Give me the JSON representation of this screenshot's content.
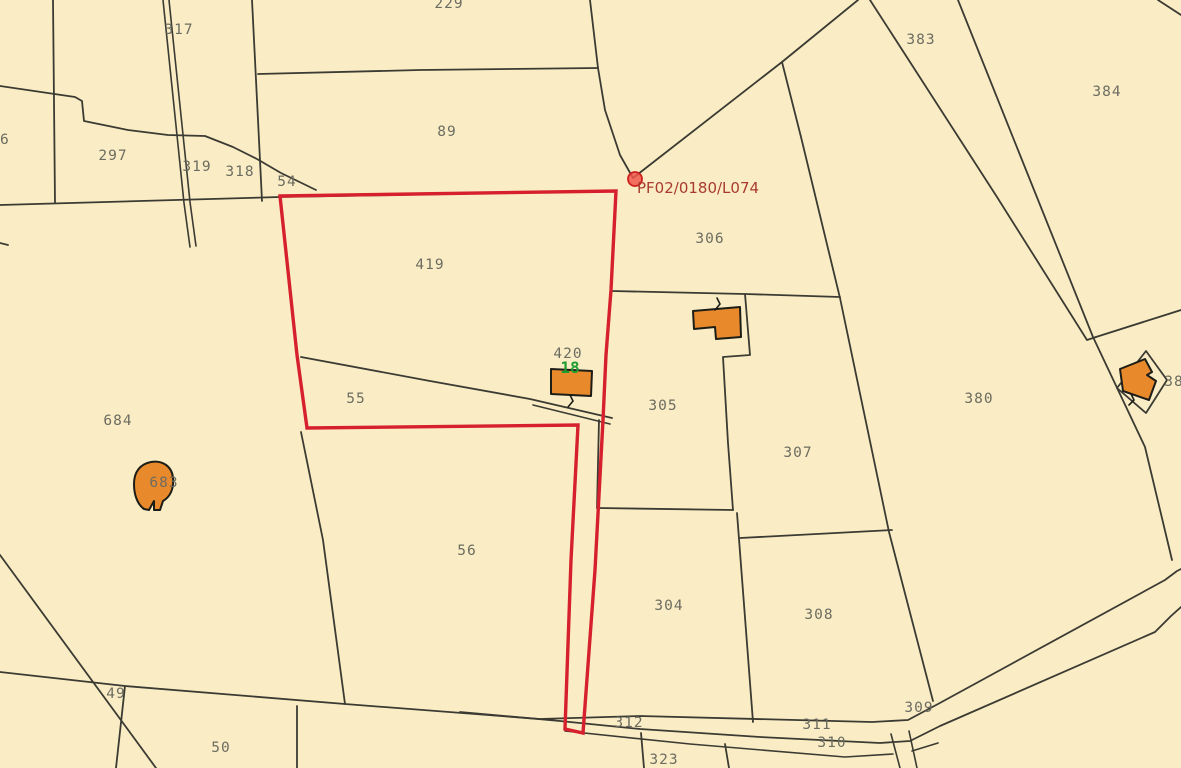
{
  "map": {
    "background_color": "#FAEDC5",
    "boundary_color": "#3B3B33",
    "building_color": "#E88A2B",
    "selection": {
      "reference": "PF02/0180/L074",
      "outline_color": "#D6202E",
      "label_color": "#A93A2F",
      "marker": "red-dot"
    },
    "house_number": {
      "text": "18",
      "color": "#1D9C31"
    },
    "parcel_labels": [
      {
        "text": "317"
      },
      {
        "text": "229"
      },
      {
        "text": "96"
      },
      {
        "text": "297"
      },
      {
        "text": "319"
      },
      {
        "text": "318"
      },
      {
        "text": "54"
      },
      {
        "text": "89"
      },
      {
        "text": "419"
      },
      {
        "text": "306"
      },
      {
        "text": "420"
      },
      {
        "text": "55"
      },
      {
        "text": "684"
      },
      {
        "text": "683"
      },
      {
        "text": "305"
      },
      {
        "text": "307"
      },
      {
        "text": "380"
      },
      {
        "text": "383"
      },
      {
        "text": "384"
      },
      {
        "text": "38"
      },
      {
        "text": "56"
      },
      {
        "text": "304"
      },
      {
        "text": "308"
      },
      {
        "text": "49"
      },
      {
        "text": "50"
      },
      {
        "text": "312"
      },
      {
        "text": "311"
      },
      {
        "text": "310"
      },
      {
        "text": "309"
      },
      {
        "text": "323"
      }
    ]
  }
}
